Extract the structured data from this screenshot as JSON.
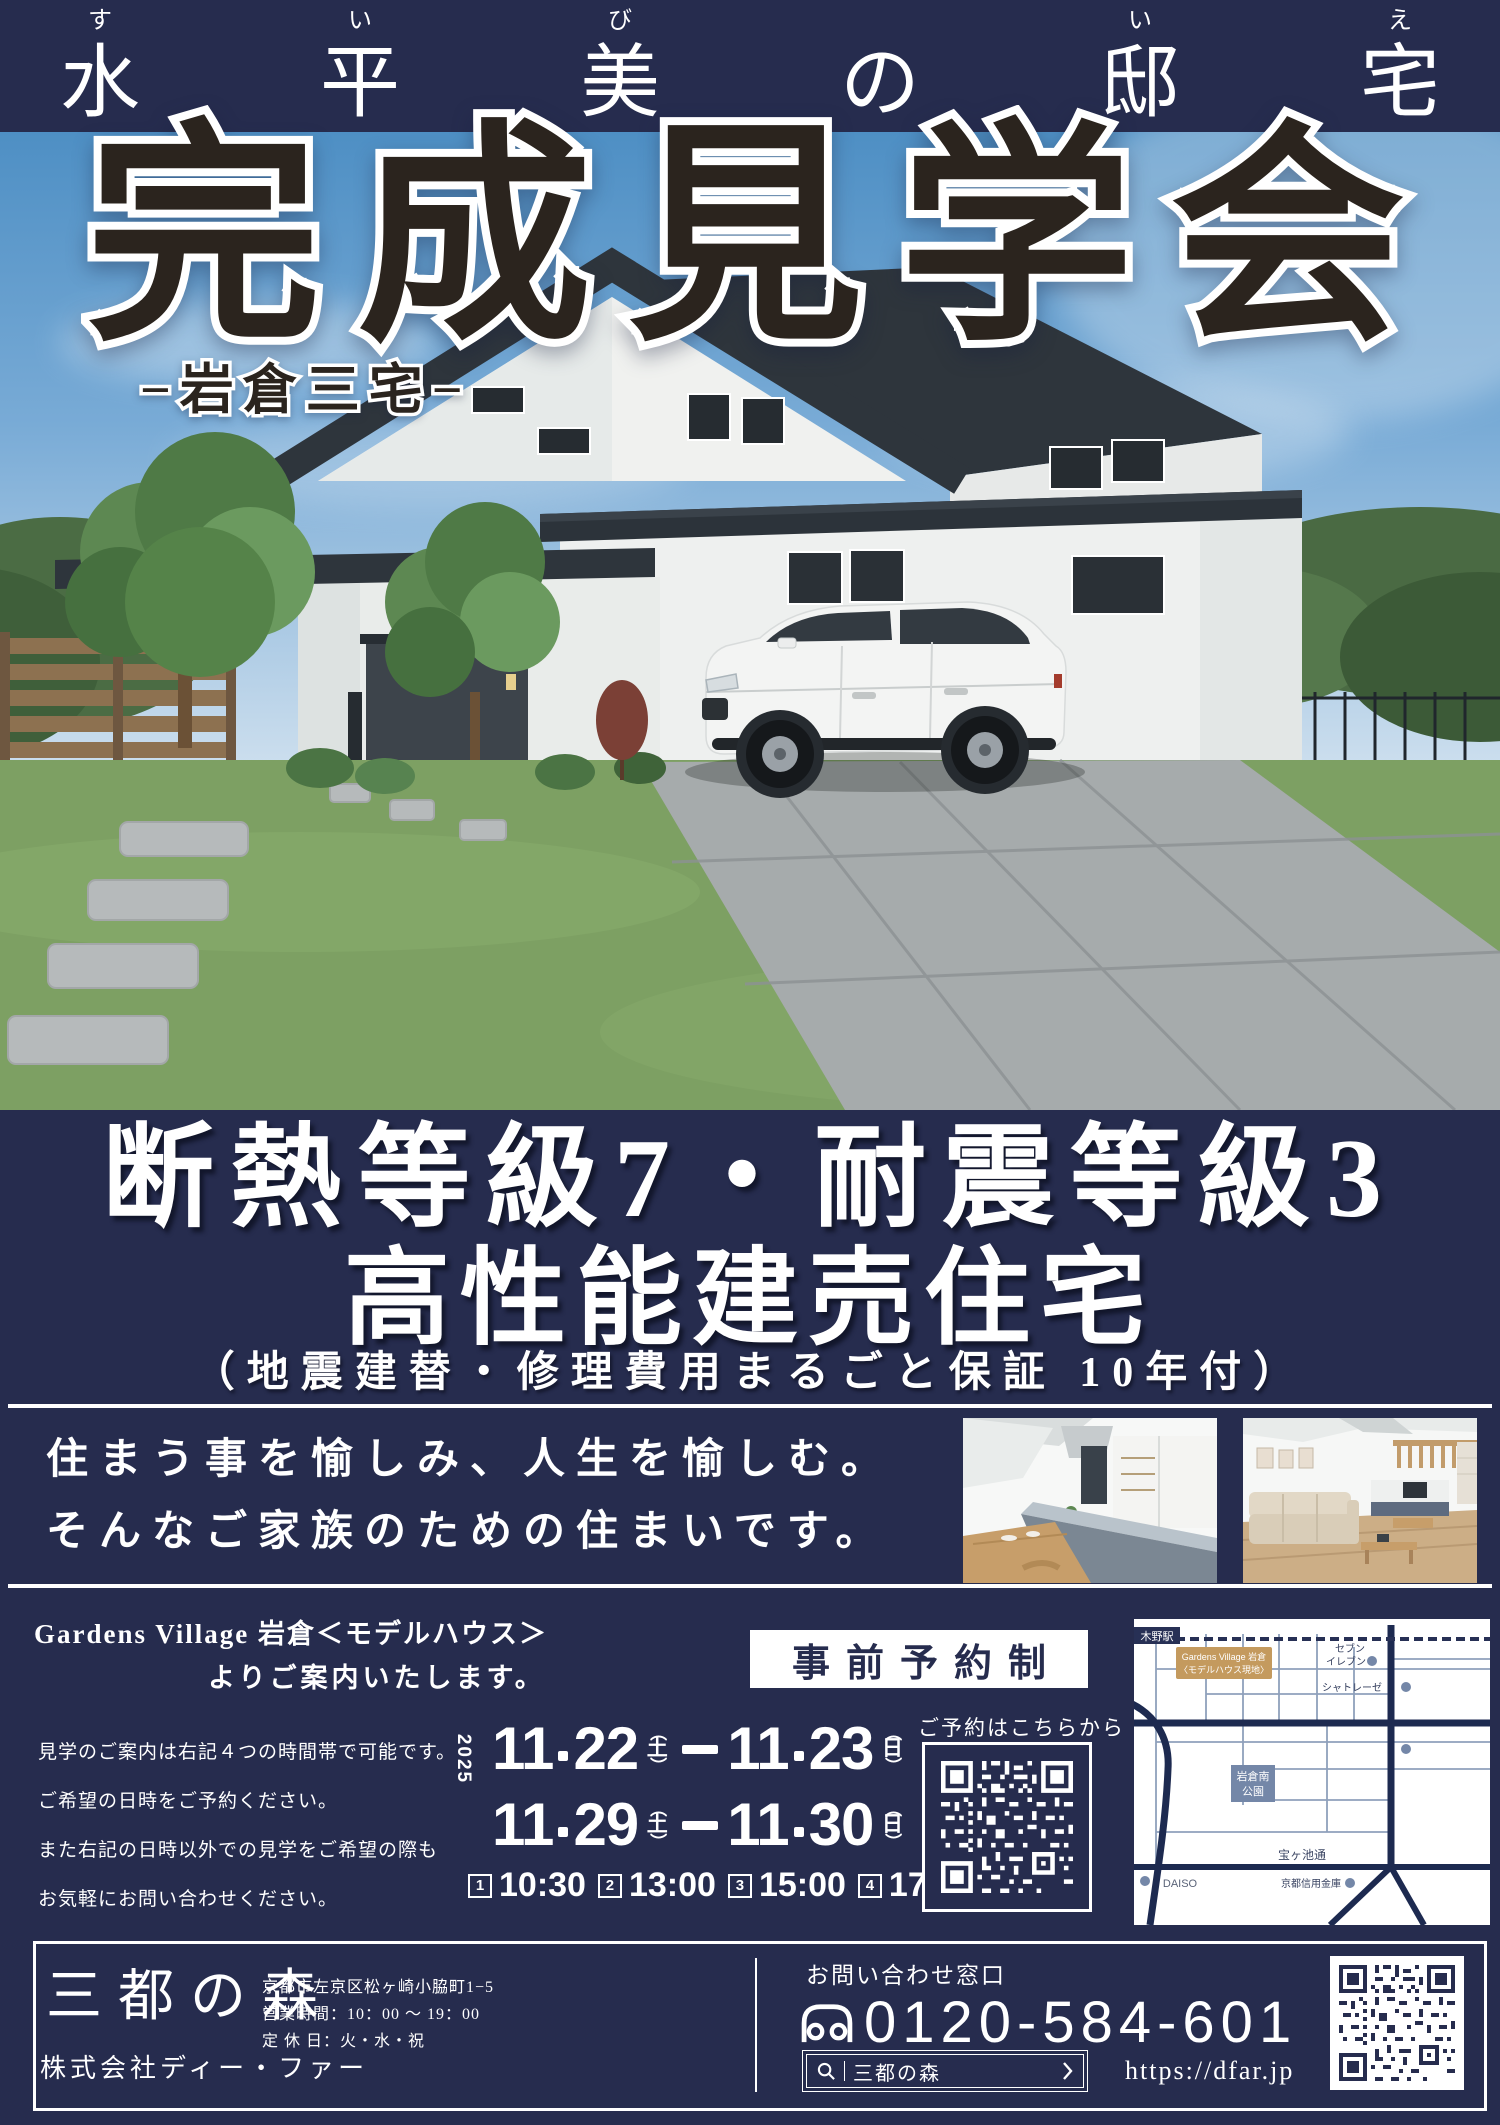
{
  "colors": {
    "navy": "#262c4e",
    "title_ink": "#2b241e",
    "sky_top": "#4e8fc4",
    "gold_badge": "#c49a5e",
    "map_road": "#1d2a50",
    "park_badge": "#7487a8",
    "white": "#ffffff"
  },
  "banner": {
    "chars": [
      {
        "k": "水",
        "f": "す"
      },
      {
        "k": "平",
        "f": "い"
      },
      {
        "k": "美",
        "f": "び"
      },
      {
        "k": "の",
        "f": ""
      },
      {
        "k": "邸",
        "f": "い"
      },
      {
        "k": "宅",
        "f": "え"
      }
    ]
  },
  "hero": {
    "title": "完成見学会",
    "subtitle": "−岩倉三宅−"
  },
  "features": {
    "line1": "断熱等級7・耐震等級3",
    "line2": "高性能建売住宅",
    "line3": "（地震建替・修理費用まるごと保証 10年付）"
  },
  "message": {
    "line1": "住まう事を愉しみ、人生を愉しむ。",
    "line2": "そんなご家族のための住まいです。"
  },
  "reservation": {
    "venue_line1": "Gardens Village 岩倉＜モデルハウス＞",
    "venue_line2": "よりご案内いたします。",
    "badge": "事前予約制",
    "notes": [
      "見学のご案内は右記４つの時間帯で可能です。",
      "ご希望の日時をご予約ください。",
      "また右記の日時以外での見学をご希望の際も",
      "お気軽にお問い合わせください。"
    ],
    "year": "2025",
    "paren_open": "（",
    "paren_close": "）",
    "dates": [
      {
        "sm": "11",
        "sd": "22",
        "sw": "土",
        "em": "11",
        "ed": "23",
        "ew": "日"
      },
      {
        "sm": "11",
        "sd": "29",
        "sw": "土",
        "em": "11",
        "ed": "30",
        "ew": "日"
      }
    ],
    "slots": [
      {
        "no": "1",
        "time": "10:30"
      },
      {
        "no": "2",
        "time": "13:00"
      },
      {
        "no": "3",
        "time": "15:00"
      },
      {
        "no": "4",
        "time": "17:00"
      }
    ],
    "qr_label": "ご予約はこちらから"
  },
  "map": {
    "station": "木野駅",
    "site_line1": "Gardens Village 岩倉",
    "site_line2": "〈モデルハウス現地〉",
    "seven_line1": "セブン",
    "seven_line2": "イレブン",
    "chateraise": "シャトレーゼ",
    "park_line1": "岩倉南",
    "park_line2": "公園",
    "road": "宝ヶ池通",
    "daiso": "DAISO",
    "bank": "京都信用金庫"
  },
  "footer": {
    "logo": "三都の森",
    "company": "株式会社ディー・ファー",
    "addr1": "京都市左京区松ヶ崎小脇町1−5",
    "addr2": "営業時間：10：00 〜 19：00",
    "addr3": "定 休 日：火・水・祝",
    "contact_label": "お問い合わせ窓口",
    "phone": "0120-584-601",
    "search_text": "三都の森",
    "url": "https://dfar.jp"
  }
}
